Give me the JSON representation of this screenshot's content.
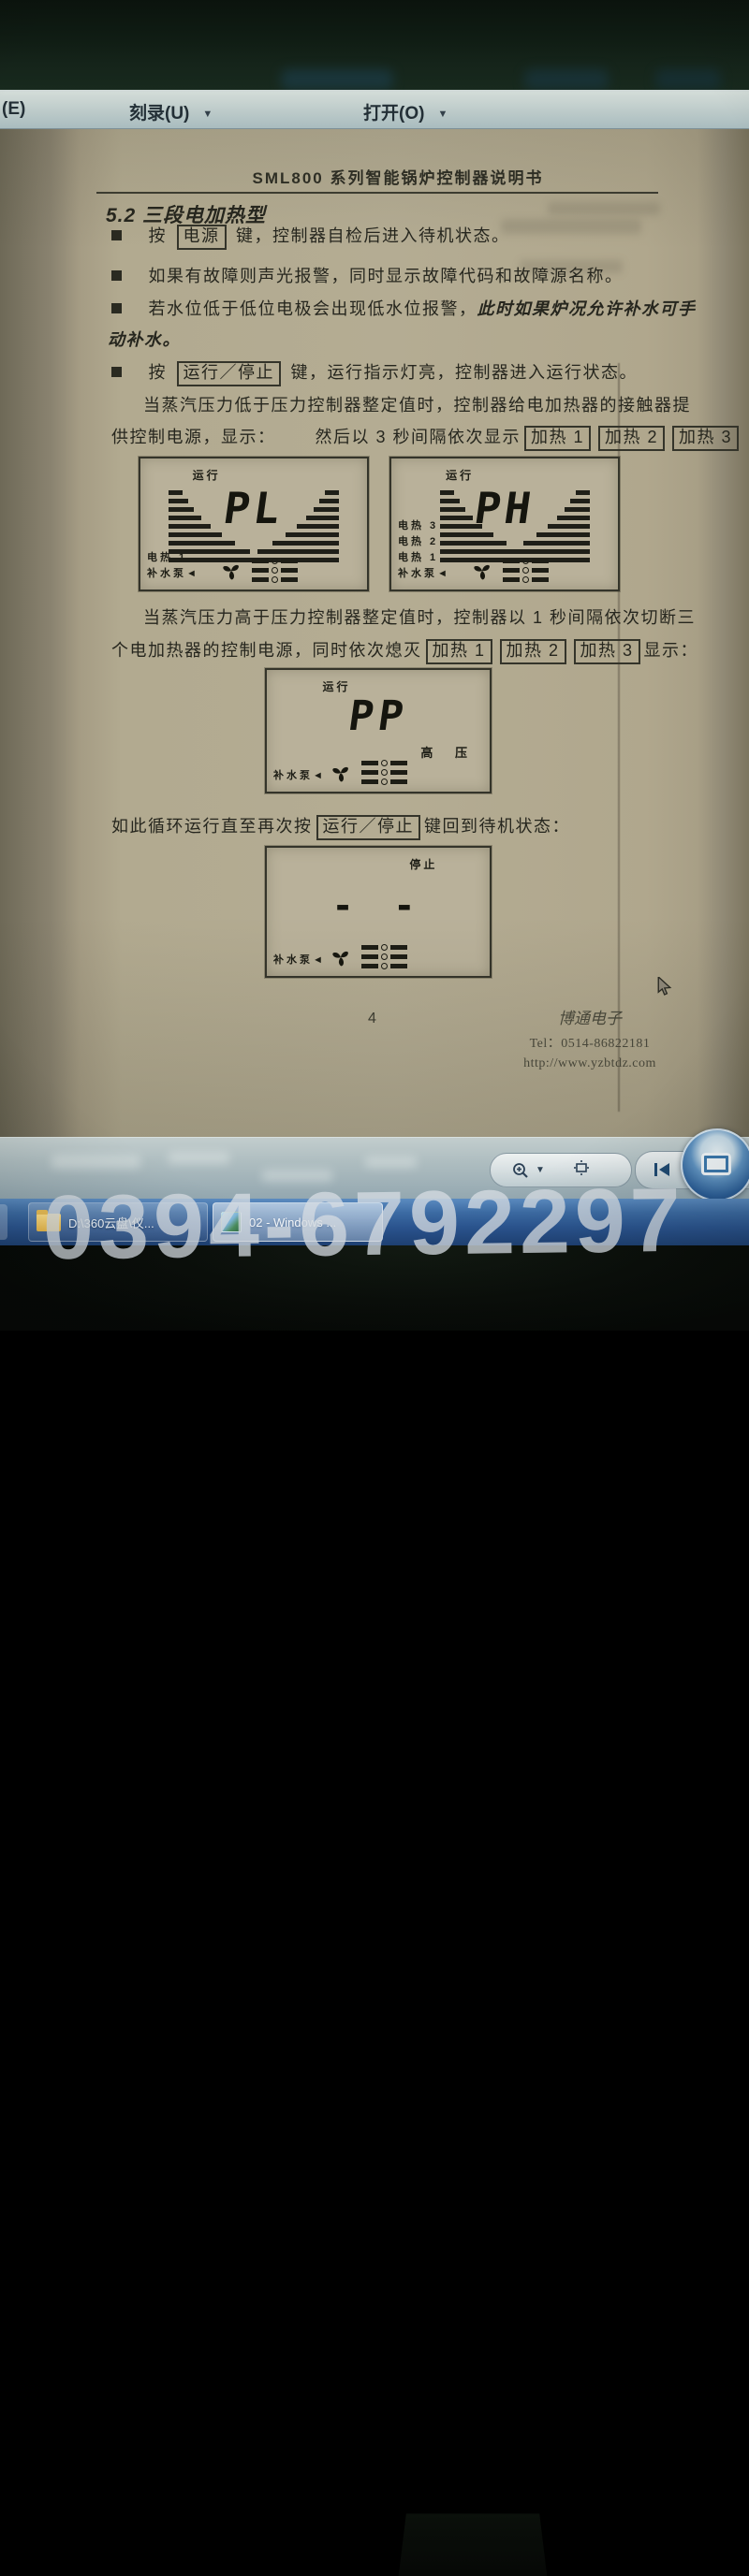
{
  "watermark": "0394-6792297",
  "menu": {
    "arrow": "▼",
    "item_e": "(E)",
    "item_burn": "刻录(U)",
    "item_open": "打开(O)"
  },
  "doc": {
    "header": "SML800 系列智能锅炉控制器说明书",
    "section": "5.2 三段电加热型",
    "b1_pre": "按",
    "b1_key": "电源",
    "b1_post": "键，控制器自检后进入待机状态。",
    "b2": "如果有故障则声光报警，同时显示故障代码和故障源名称。",
    "b3_normal": "若水位低于低位电极会出现低水位报警，",
    "b3_italic": "此时如果炉况允许补水可手",
    "b3_italic2": "动补水。",
    "b4_pre": "按",
    "b4_key": "运行／停止",
    "b4_post": "键，运行指示灯亮，控制器进入运行状态。",
    "p1_l1": "当蒸汽压力低于压力控制器整定值时，控制器给电加热器的接触器提",
    "p1_l2a": "供控制电源，显示：",
    "p1_l2b": "然后以 3 秒间隔依次显示",
    "heat1": "加热 1",
    "heat2": "加热 2",
    "heat3": "加热 3",
    "p2_l1": "当蒸汽压力高于压力控制器整定值时，控制器以 1 秒间隔依次切断三",
    "p2_l2a": "个电加热器的控制电源，同时依次熄灭",
    "p2_l2b": "显示：",
    "p3_pre": "如此循环运行直至再次按",
    "p3_key": "运行／停止",
    "p3_post": "键回到待机状态：",
    "page_num": "4",
    "company": "博通电子",
    "tel": "Tel：0514-86822181",
    "url": "http://www.yzbtdz.com"
  },
  "displays": [
    {
      "status": "运行",
      "value": "PL",
      "l1": "电热 1",
      "l2": "补水泵◄"
    },
    {
      "status": "运行",
      "value": "PH",
      "l1": "电热 3",
      "l2": "电热 2",
      "l3": "电热 1",
      "l4": "补水泵◄"
    },
    {
      "status": "运行",
      "value": "PP",
      "right": "高 压",
      "l1": "补水泵◄"
    },
    {
      "status": "停止",
      "value": "- -",
      "l1": "补水泵◄"
    }
  ],
  "taskbar": {
    "btn1": "D:\\360云盘\\仪...",
    "btn2": "02 - Windows ..."
  }
}
